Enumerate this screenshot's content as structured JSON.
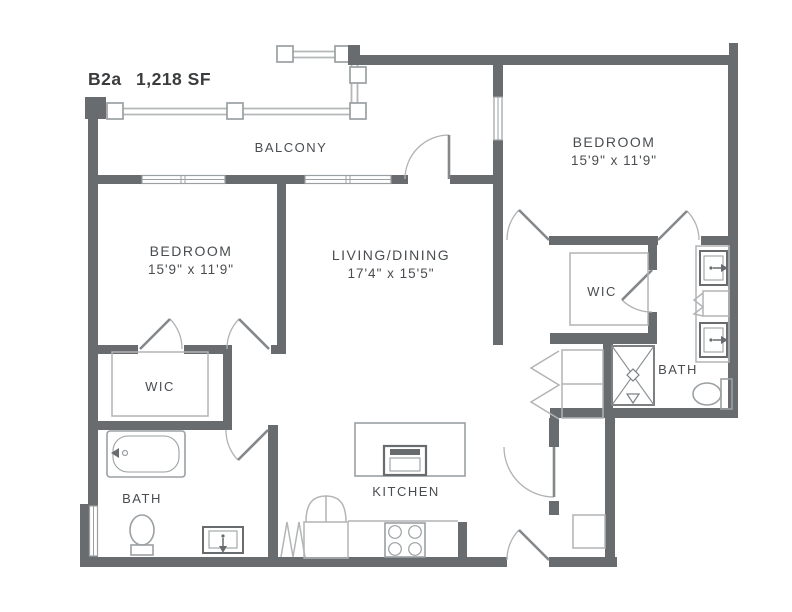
{
  "title": {
    "code": "B2a",
    "area": "1,218 SF"
  },
  "rooms": {
    "balcony": {
      "label": "BALCONY"
    },
    "bedroom_right": {
      "label": "BEDROOM",
      "dims": "15'9\" x 11'9\""
    },
    "bedroom_left": {
      "label": "BEDROOM",
      "dims": "15'9\" x 11'9\""
    },
    "living_dining": {
      "label": "LIVING/DINING",
      "dims": "17'4\" x 15'5\""
    },
    "wic_left": {
      "label": "WIC"
    },
    "wic_right": {
      "label": "WIC"
    },
    "bath_left": {
      "label": "BATH"
    },
    "bath_right": {
      "label": "BATH"
    },
    "kitchen": {
      "label": "KITCHEN"
    }
  },
  "fixtures": [
    "bathtub",
    "toilet",
    "sink-vanity",
    "double-vanity",
    "shower",
    "washer-dryer-stack",
    "refrigerator",
    "range-stove",
    "kitchen-island-sink",
    "closet-shelf",
    "bifold-doors",
    "balcony-railing"
  ],
  "colors": {
    "wall": "#696c6f",
    "fixture": "#9aa0a3",
    "fixture_light": "#b2b4b6",
    "text": "#4a4d50",
    "title": "#3a3c3e",
    "background": "#ffffff"
  }
}
